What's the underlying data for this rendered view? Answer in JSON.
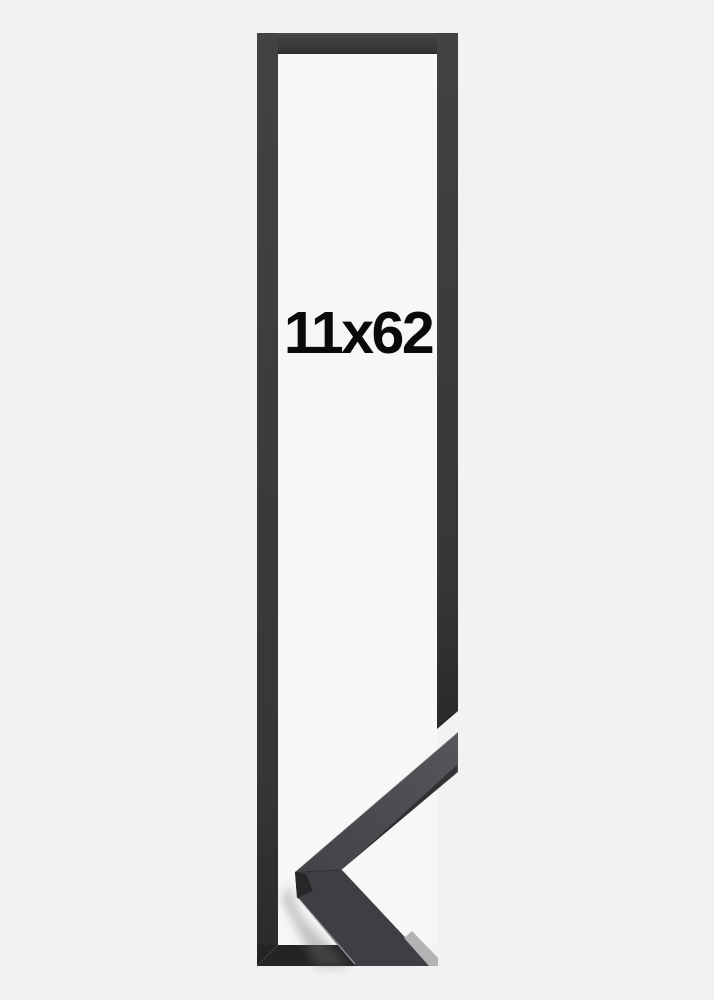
{
  "product_image": {
    "size_label": "11x62",
    "frame_style": "black-narrow-frame-with-corner-sample",
    "colors": {
      "background": "#f2f2f3",
      "inner_background": "#f7f7f8",
      "frame": "#39393b",
      "frame_bottom": "#242426",
      "sample_face": "#47484c",
      "sample_face_front": "#3e3f43",
      "sample_edge_light": "#b2b3b5",
      "sample_side_dark": "#27272a",
      "label_text": "#0a0a0a"
    }
  }
}
